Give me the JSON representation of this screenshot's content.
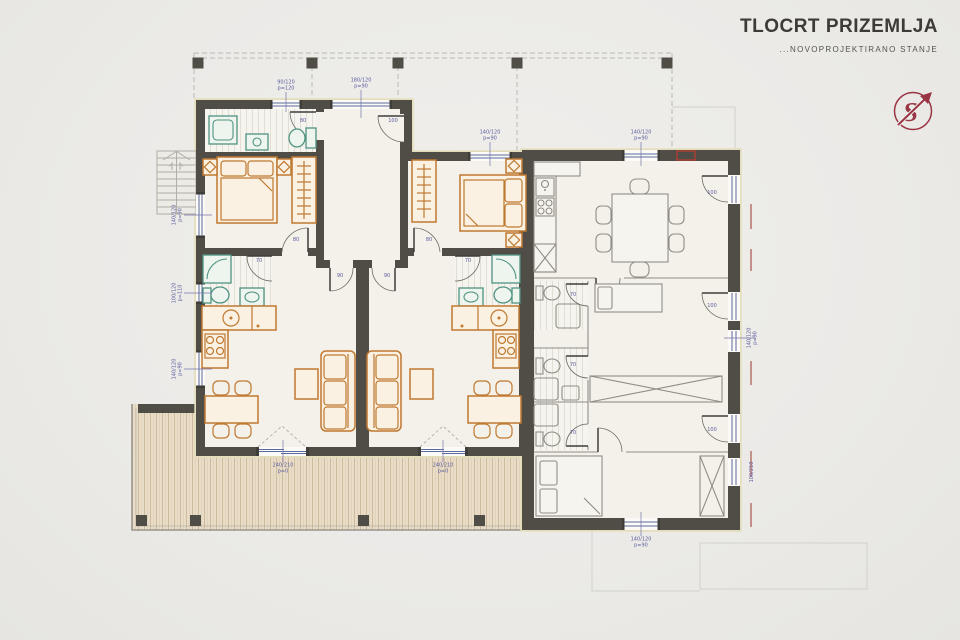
{
  "page": {
    "title": "TLOCRT PRIZEMLJA",
    "subtitle": "...NOVOPROJEKTIRANO STANJE"
  },
  "logo": {
    "monogram": "S"
  },
  "colors": {
    "paper": "#ecebe8",
    "wall": "#504d47",
    "wall_halo": "#e4ddbb",
    "floor": "#f3f1ea",
    "new_furniture_accent": "#bf7930",
    "sanitary_accent": "#4f9382",
    "existing_lines": "#908d85",
    "window_glass": "#5b6b9e",
    "dimension_text": "#5c5c9e",
    "logo_red": "#9a3644",
    "marker_red": "#a03d36",
    "deck_wood": "#e9ddc8",
    "canopy_dash": "#bcb9b1"
  },
  "plan": {
    "drawing_type": "ground-floor architectural plan",
    "dimension_labels": [
      {
        "text": "180/120\np=90",
        "x": 361,
        "y": 84,
        "rot": 0
      },
      {
        "text": "90/120\np=120",
        "x": 286,
        "y": 86,
        "rot": 0
      },
      {
        "text": "140/120\np=90",
        "x": 490,
        "y": 136,
        "rot": 0
      },
      {
        "text": "140/120\np=90",
        "x": 641,
        "y": 136,
        "rot": 0
      },
      {
        "text": "140/120\np=90",
        "x": 178,
        "y": 215,
        "rot": -90
      },
      {
        "text": "100/120\np=110",
        "x": 178,
        "y": 293,
        "rot": -90
      },
      {
        "text": "140/120\np=90",
        "x": 178,
        "y": 369,
        "rot": -90
      },
      {
        "text": "240/210\np=0",
        "x": 283,
        "y": 469,
        "rot": 0
      },
      {
        "text": "240/210\np=0",
        "x": 443,
        "y": 469,
        "rot": 0
      },
      {
        "text": "140/120\np=90",
        "x": 641,
        "y": 543,
        "rot": 0
      },
      {
        "text": "140/120\np=90",
        "x": 753,
        "y": 338,
        "rot": -90
      },
      {
        "text": "100/210",
        "x": 753,
        "y": 472,
        "rot": -90
      },
      {
        "text": "90",
        "x": 340,
        "y": 277,
        "rot": 0
      },
      {
        "text": "90",
        "x": 387,
        "y": 277,
        "rot": 0
      },
      {
        "text": "80",
        "x": 296,
        "y": 241,
        "rot": 0
      },
      {
        "text": "80",
        "x": 429,
        "y": 241,
        "rot": 0
      },
      {
        "text": "70",
        "x": 259,
        "y": 262,
        "rot": 0
      },
      {
        "text": "70",
        "x": 468,
        "y": 262,
        "rot": 0
      },
      {
        "text": "80",
        "x": 303,
        "y": 122,
        "rot": 0
      },
      {
        "text": "100",
        "x": 393,
        "y": 122,
        "rot": 0
      },
      {
        "text": "70",
        "x": 573,
        "y": 296,
        "rot": 0
      },
      {
        "text": "70",
        "x": 573,
        "y": 366,
        "rot": 0
      },
      {
        "text": "70",
        "x": 573,
        "y": 434,
        "rot": 0
      },
      {
        "text": "100",
        "x": 712,
        "y": 194,
        "rot": 0
      },
      {
        "text": "100",
        "x": 712,
        "y": 307,
        "rot": 0
      },
      {
        "text": "100",
        "x": 712,
        "y": 431,
        "rot": 0
      }
    ]
  }
}
